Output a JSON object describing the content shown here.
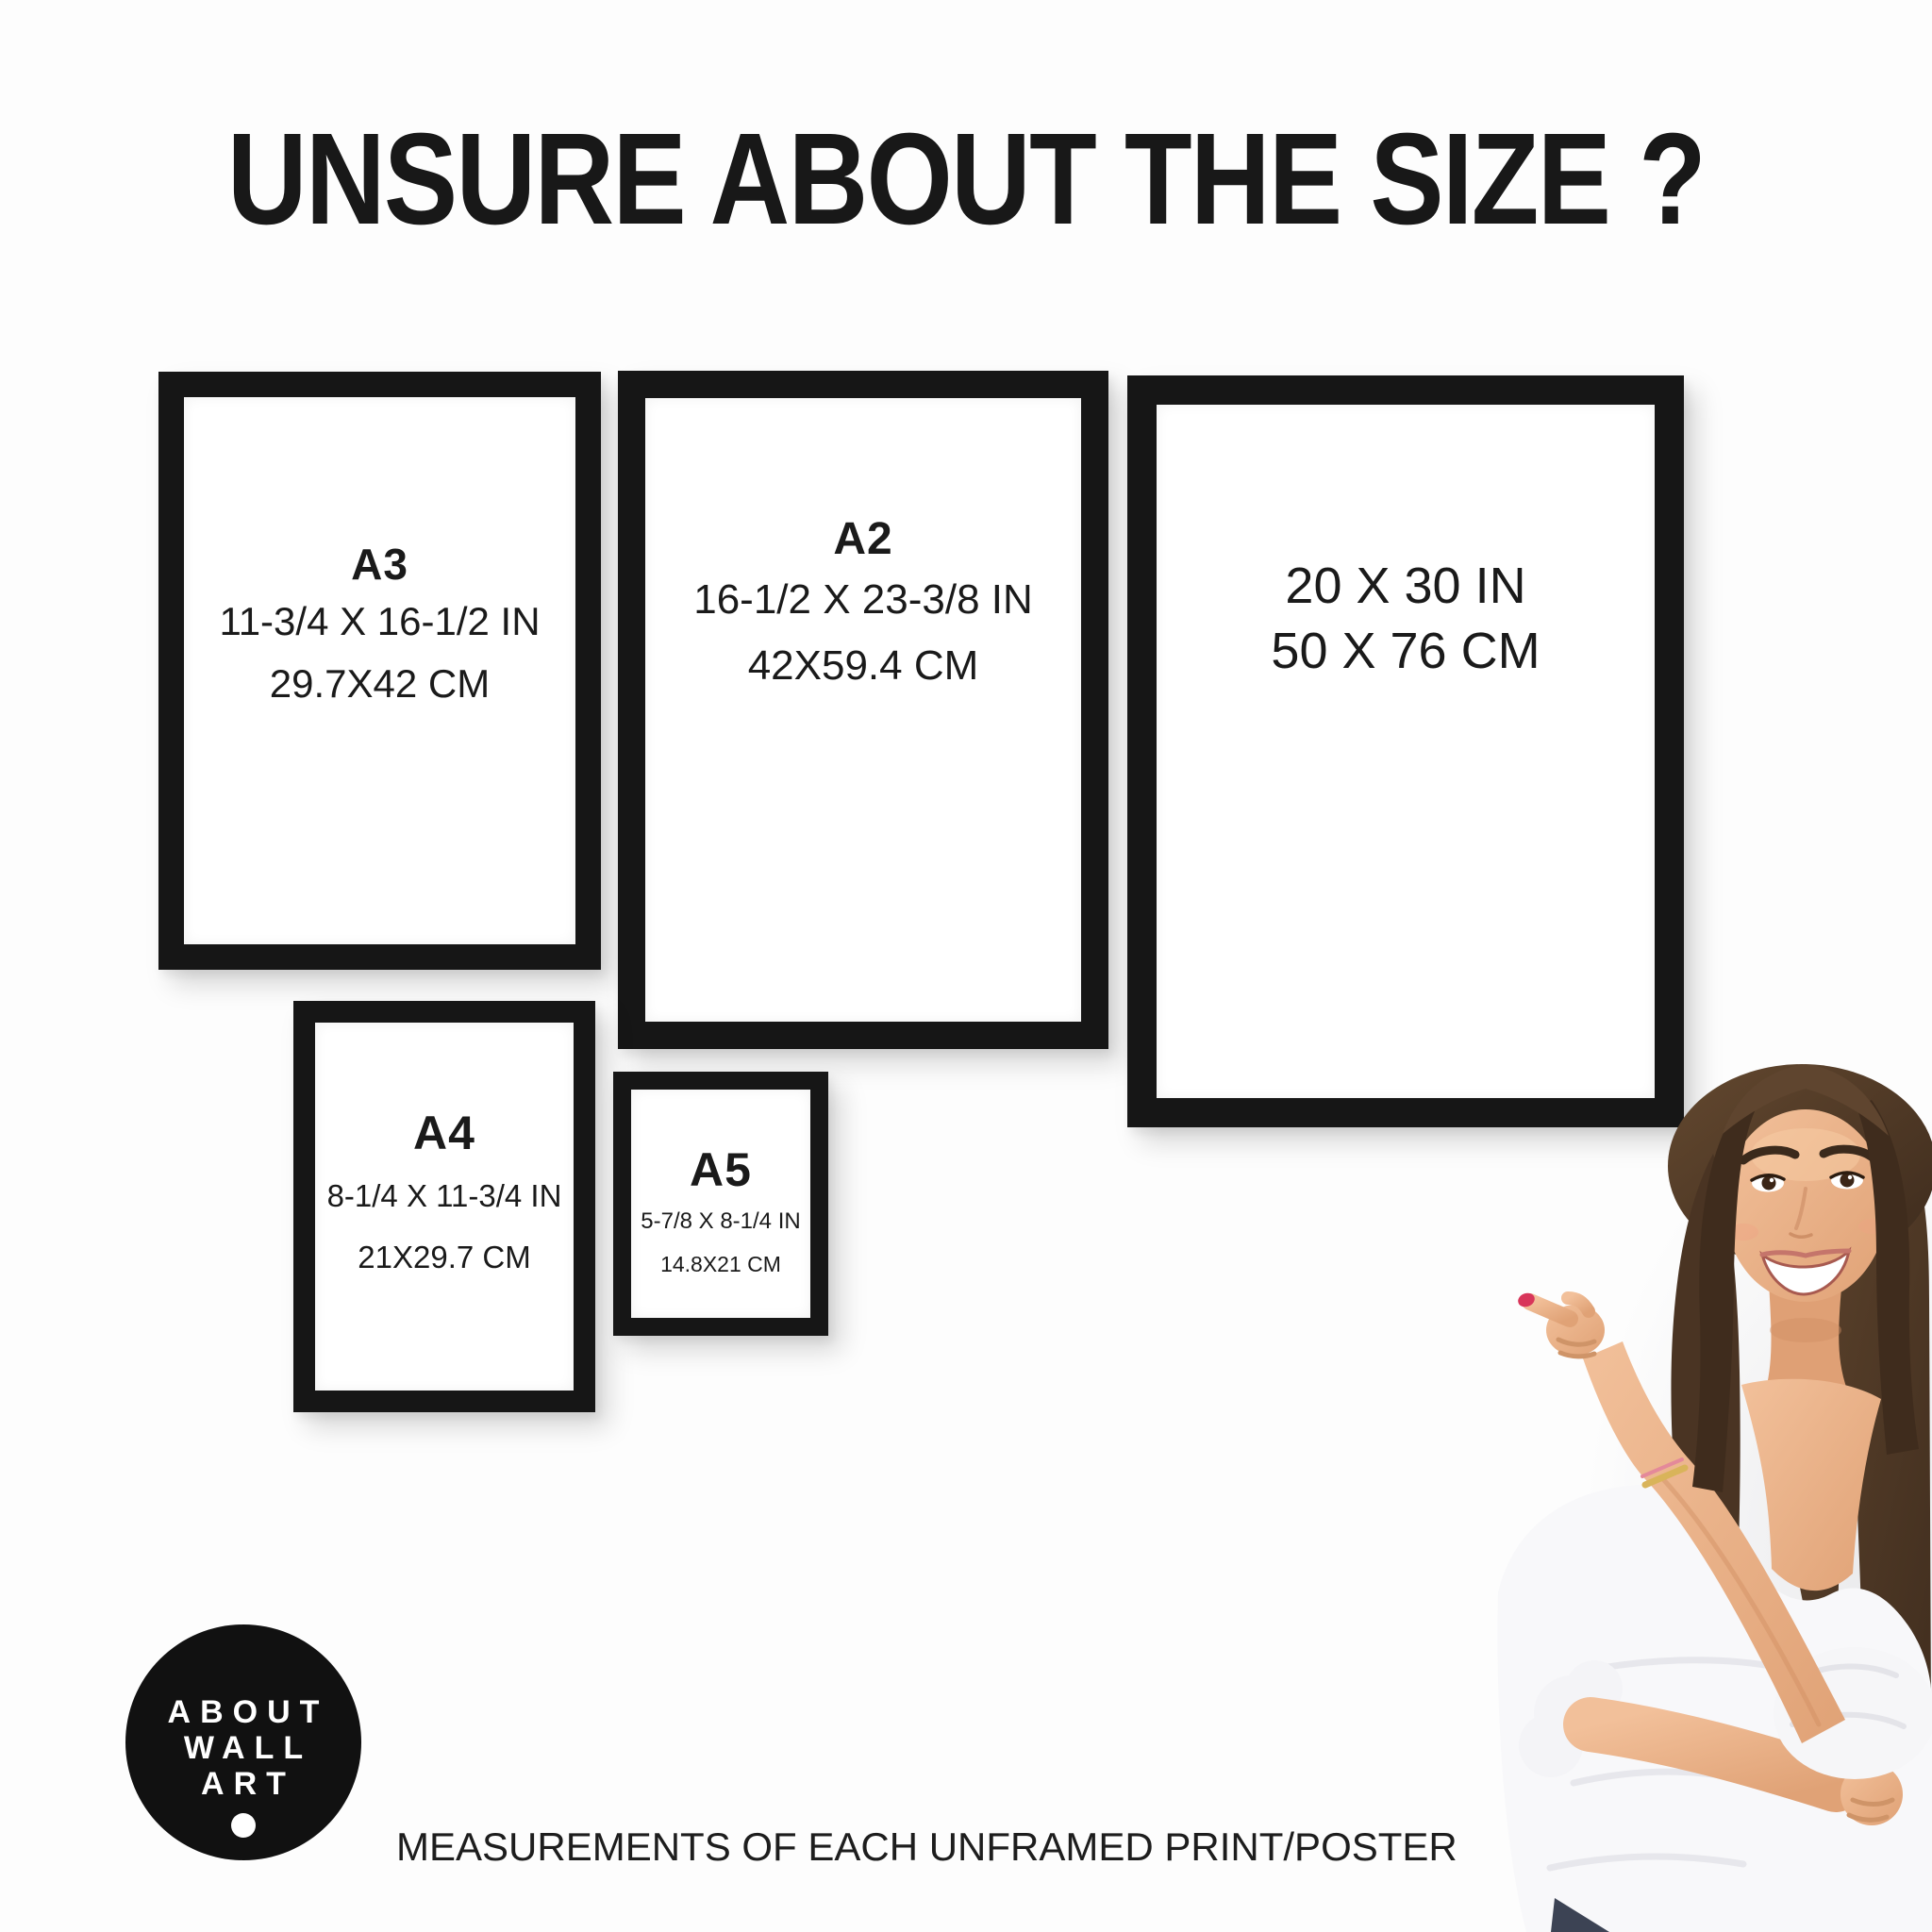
{
  "title": "UNSURE ABOUT THE SIZE ?",
  "sizes": {
    "a3": {
      "label": "A3",
      "inches": "11-3/4 X 16-1/2 IN",
      "cm": "29.7X42 CM"
    },
    "a2": {
      "label": "A2",
      "inches": "16-1/2 X 23-3/8 IN",
      "cm": "42X59.4 CM"
    },
    "p2030": {
      "inches": "20 X 30 IN",
      "cm": "50 X 76 CM"
    },
    "a4": {
      "label": "A4",
      "inches": "8-1/4 X 11-3/4 IN",
      "cm": "21X29.7 CM"
    },
    "a5": {
      "label": "A5",
      "inches": "5-7/8 X 8-1/4 IN",
      "cm": "14.8X21 CM"
    }
  },
  "logo": {
    "lines": [
      "ABOUT",
      "WALL",
      "ART"
    ]
  },
  "footer": "MEASUREMENTS OF EACH UNFRAMED PRINT/POSTER",
  "colors": {
    "background": "#fdfdfd",
    "frame": "#161616",
    "text": "#1a1a1a",
    "logo_bg": "#111111",
    "logo_text": "#ffffff",
    "nail": "#d8355a",
    "hair": "#4a3423",
    "skin": "#e8b48d",
    "blouse": "#f8f8fa"
  }
}
